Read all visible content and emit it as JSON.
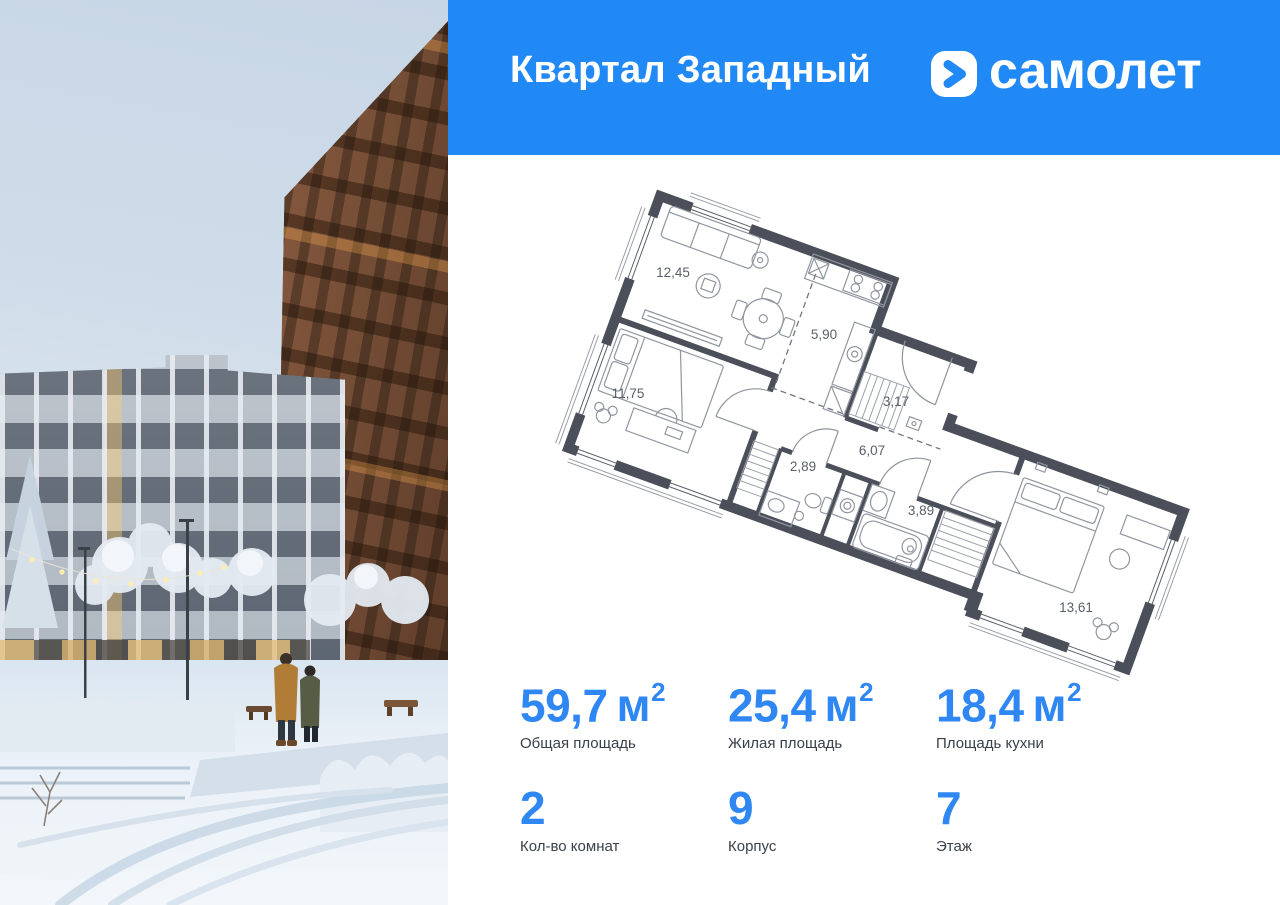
{
  "header": {
    "project_title": "Квартал Западный",
    "brand_name": "самолет",
    "bg_color": "#2189f5"
  },
  "plan": {
    "rooms": [
      {
        "name": "living-room",
        "area": "12,45"
      },
      {
        "name": "kitchen",
        "area": "5,90"
      },
      {
        "name": "bedroom",
        "area": "11,75"
      },
      {
        "name": "hallway",
        "area": "3,17"
      },
      {
        "name": "corridor",
        "area": "6,07"
      },
      {
        "name": "bathroom",
        "area": "2,89"
      },
      {
        "name": "bathroom-2",
        "area": "3,89"
      },
      {
        "name": "bedroom-2",
        "area": "13,61"
      }
    ]
  },
  "stats": {
    "row1": [
      {
        "value": "59,7",
        "unit": "м",
        "sup": "2",
        "label": "Общая площадь"
      },
      {
        "value": "25,4",
        "unit": "м",
        "sup": "2",
        "label": "Жилая площадь"
      },
      {
        "value": "18,4",
        "unit": "м",
        "sup": "2",
        "label": "Площадь кухни"
      }
    ],
    "row2": [
      {
        "value": "2",
        "label": "Кол-во комнат"
      },
      {
        "value": "9",
        "label": "Корпус"
      },
      {
        "value": "7",
        "label": "Этаж"
      }
    ]
  },
  "colors": {
    "header_bg": "#2189f5",
    "accent_number": "#2e87f2",
    "plan_wall": "#4a4f59"
  }
}
